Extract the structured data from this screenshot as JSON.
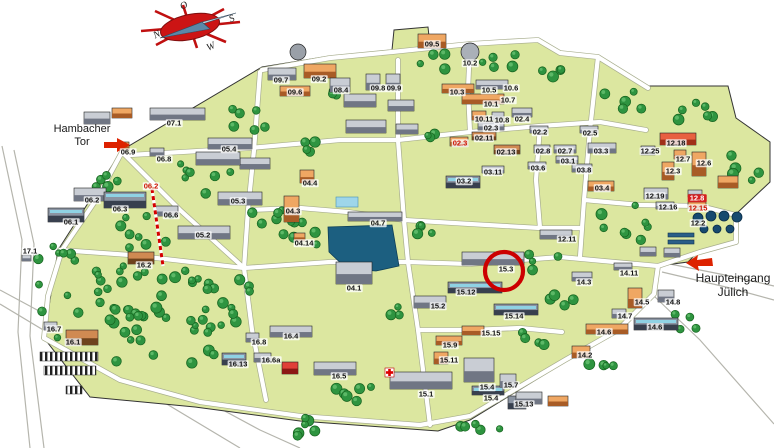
{
  "compass": {
    "n": "N",
    "o": "O",
    "s": "S",
    "w": "W"
  },
  "gates": {
    "hambacher": {
      "line1": "Hambacher",
      "line2": "Tor"
    },
    "haupteingang": {
      "line1": "Haupteingang",
      "line2": "Jülich"
    }
  },
  "highlight": {
    "building": "15.3"
  },
  "colors": {
    "ground": "#dce7a0",
    "tree": "#2e9440",
    "pond": "#1c5f80",
    "accent_red": "#cc0000",
    "building_orange": "#e0854a",
    "building_gray": "#b8bcc4"
  },
  "map": {
    "labels": [
      {
        "text": "09.7",
        "x": 281,
        "y": 80,
        "style": "normal"
      },
      {
        "text": "09.2",
        "x": 319,
        "y": 79,
        "style": "normal"
      },
      {
        "text": "09.6",
        "x": 295,
        "y": 92,
        "style": "normal"
      },
      {
        "text": "08.4",
        "x": 341,
        "y": 90,
        "style": "normal"
      },
      {
        "text": "09.8",
        "x": 378,
        "y": 88,
        "style": "normal"
      },
      {
        "text": "09.9",
        "x": 394,
        "y": 88,
        "style": "normal"
      },
      {
        "text": "09.5",
        "x": 432,
        "y": 44,
        "style": "normal"
      },
      {
        "text": "10.2",
        "x": 470,
        "y": 63,
        "style": "normal"
      },
      {
        "text": "10.3",
        "x": 457,
        "y": 92,
        "style": "normal"
      },
      {
        "text": "10.5",
        "x": 489,
        "y": 90,
        "style": "normal"
      },
      {
        "text": "10.6",
        "x": 511,
        "y": 88,
        "style": "normal"
      },
      {
        "text": "10.1",
        "x": 491,
        "y": 104,
        "style": "normal"
      },
      {
        "text": "10.7",
        "x": 508,
        "y": 100,
        "style": "normal"
      },
      {
        "text": "10.11",
        "x": 484,
        "y": 119,
        "style": "normal"
      },
      {
        "text": "10.8",
        "x": 502,
        "y": 120,
        "style": "normal"
      },
      {
        "text": "02.4",
        "x": 522,
        "y": 119,
        "style": "normal"
      },
      {
        "text": "02.3",
        "x": 491,
        "y": 128,
        "style": "normal"
      },
      {
        "text": "02.11",
        "x": 484,
        "y": 138,
        "style": "normal"
      },
      {
        "text": "02.3",
        "x": 460,
        "y": 143,
        "style": "red"
      },
      {
        "text": "02.13",
        "x": 506,
        "y": 152,
        "style": "normal"
      },
      {
        "text": "02.2",
        "x": 540,
        "y": 132,
        "style": "normal"
      },
      {
        "text": "02.5",
        "x": 590,
        "y": 133,
        "style": "normal"
      },
      {
        "text": "02.8",
        "x": 543,
        "y": 151,
        "style": "normal"
      },
      {
        "text": "02.7",
        "x": 565,
        "y": 151,
        "style": "normal"
      },
      {
        "text": "03.1",
        "x": 568,
        "y": 161,
        "style": "normal"
      },
      {
        "text": "03.6",
        "x": 538,
        "y": 168,
        "style": "normal"
      },
      {
        "text": "03.8",
        "x": 584,
        "y": 170,
        "style": "normal"
      },
      {
        "text": "03.11",
        "x": 493,
        "y": 172,
        "style": "normal"
      },
      {
        "text": "03.2",
        "x": 464,
        "y": 181,
        "style": "normal"
      },
      {
        "text": "03.3",
        "x": 601,
        "y": 151,
        "style": "normal"
      },
      {
        "text": "03.4",
        "x": 602,
        "y": 188,
        "style": "normal"
      },
      {
        "text": "12.18",
        "x": 676,
        "y": 143,
        "style": "normal"
      },
      {
        "text": "12.25",
        "x": 650,
        "y": 151,
        "style": "normal"
      },
      {
        "text": "12.7",
        "x": 683,
        "y": 159,
        "style": "normal"
      },
      {
        "text": "12.6",
        "x": 704,
        "y": 163,
        "style": "normal"
      },
      {
        "text": "12.3",
        "x": 673,
        "y": 171,
        "style": "normal"
      },
      {
        "text": "12.19",
        "x": 655,
        "y": 196,
        "style": "normal"
      },
      {
        "text": "12.16",
        "x": 668,
        "y": 207,
        "style": "normal"
      },
      {
        "text": "12.8",
        "x": 697,
        "y": 198,
        "style": "redbox"
      },
      {
        "text": "12.15",
        "x": 698,
        "y": 208,
        "style": "red"
      },
      {
        "text": "12.2",
        "x": 698,
        "y": 223,
        "style": "normal"
      },
      {
        "text": "12.11",
        "x": 567,
        "y": 239,
        "style": "normal"
      },
      {
        "text": "14.11",
        "x": 629,
        "y": 273,
        "style": "normal"
      },
      {
        "text": "14.3",
        "x": 584,
        "y": 282,
        "style": "normal"
      },
      {
        "text": "14.5",
        "x": 642,
        "y": 302,
        "style": "normal"
      },
      {
        "text": "14.8",
        "x": 673,
        "y": 302,
        "style": "normal"
      },
      {
        "text": "14.7",
        "x": 625,
        "y": 316,
        "style": "normal"
      },
      {
        "text": "14.6",
        "x": 604,
        "y": 332,
        "style": "normal"
      },
      {
        "text": "14.6",
        "x": 655,
        "y": 327,
        "style": "normal"
      },
      {
        "text": "14.2",
        "x": 585,
        "y": 355,
        "style": "normal"
      },
      {
        "text": "15.3",
        "x": 506,
        "y": 269,
        "style": "normal"
      },
      {
        "text": "15.12",
        "x": 466,
        "y": 292,
        "style": "normal"
      },
      {
        "text": "15.2",
        "x": 438,
        "y": 306,
        "style": "normal"
      },
      {
        "text": "15.14",
        "x": 514,
        "y": 316,
        "style": "normal"
      },
      {
        "text": "15.15",
        "x": 491,
        "y": 333,
        "style": "normal"
      },
      {
        "text": "15.9",
        "x": 450,
        "y": 345,
        "style": "normal"
      },
      {
        "text": "15.11",
        "x": 449,
        "y": 360,
        "style": "normal"
      },
      {
        "text": "15.1",
        "x": 426,
        "y": 394,
        "style": "normal"
      },
      {
        "text": "15.4",
        "x": 487,
        "y": 387,
        "style": "normal"
      },
      {
        "text": "15.4",
        "x": 491,
        "y": 398,
        "style": "normal"
      },
      {
        "text": "15.7",
        "x": 511,
        "y": 385,
        "style": "normal"
      },
      {
        "text": "15.13",
        "x": 524,
        "y": 404,
        "style": "normal"
      },
      {
        "text": "16.4",
        "x": 291,
        "y": 336,
        "style": "normal"
      },
      {
        "text": "16.8",
        "x": 259,
        "y": 342,
        "style": "normal"
      },
      {
        "text": "16.13",
        "x": 238,
        "y": 364,
        "style": "normal"
      },
      {
        "text": "16.6a",
        "x": 271,
        "y": 360,
        "style": "normal"
      },
      {
        "text": "16.5",
        "x": 339,
        "y": 376,
        "style": "normal"
      },
      {
        "text": "16.1",
        "x": 73,
        "y": 342,
        "style": "normal"
      },
      {
        "text": "16.7",
        "x": 54,
        "y": 329,
        "style": "normal"
      },
      {
        "text": "16.2",
        "x": 144,
        "y": 265,
        "style": "normal"
      },
      {
        "text": "17.1",
        "x": 30,
        "y": 251,
        "style": "normal"
      },
      {
        "text": "06.9",
        "x": 128,
        "y": 152,
        "style": "normal"
      },
      {
        "text": "06.8",
        "x": 164,
        "y": 159,
        "style": "normal"
      },
      {
        "text": "07.1",
        "x": 174,
        "y": 123,
        "style": "normal"
      },
      {
        "text": "06.2",
        "x": 92,
        "y": 200,
        "style": "normal"
      },
      {
        "text": "06.1",
        "x": 71,
        "y": 222,
        "style": "normal"
      },
      {
        "text": "06.3",
        "x": 120,
        "y": 209,
        "style": "normal"
      },
      {
        "text": "06.6",
        "x": 171,
        "y": 215,
        "style": "normal"
      },
      {
        "text": "06.2",
        "x": 151,
        "y": 186,
        "style": "red"
      },
      {
        "text": "05.4",
        "x": 229,
        "y": 149,
        "style": "normal"
      },
      {
        "text": "05.3",
        "x": 238,
        "y": 201,
        "style": "normal"
      },
      {
        "text": "05.2",
        "x": 203,
        "y": 235,
        "style": "normal"
      },
      {
        "text": "04.4",
        "x": 310,
        "y": 183,
        "style": "normal"
      },
      {
        "text": "04.3",
        "x": 293,
        "y": 211,
        "style": "normal"
      },
      {
        "text": "04.14",
        "x": 304,
        "y": 243,
        "style": "normal"
      },
      {
        "text": "04.7",
        "x": 378,
        "y": 223,
        "style": "normal"
      },
      {
        "text": "04.1",
        "x": 354,
        "y": 288,
        "style": "normal"
      }
    ]
  }
}
